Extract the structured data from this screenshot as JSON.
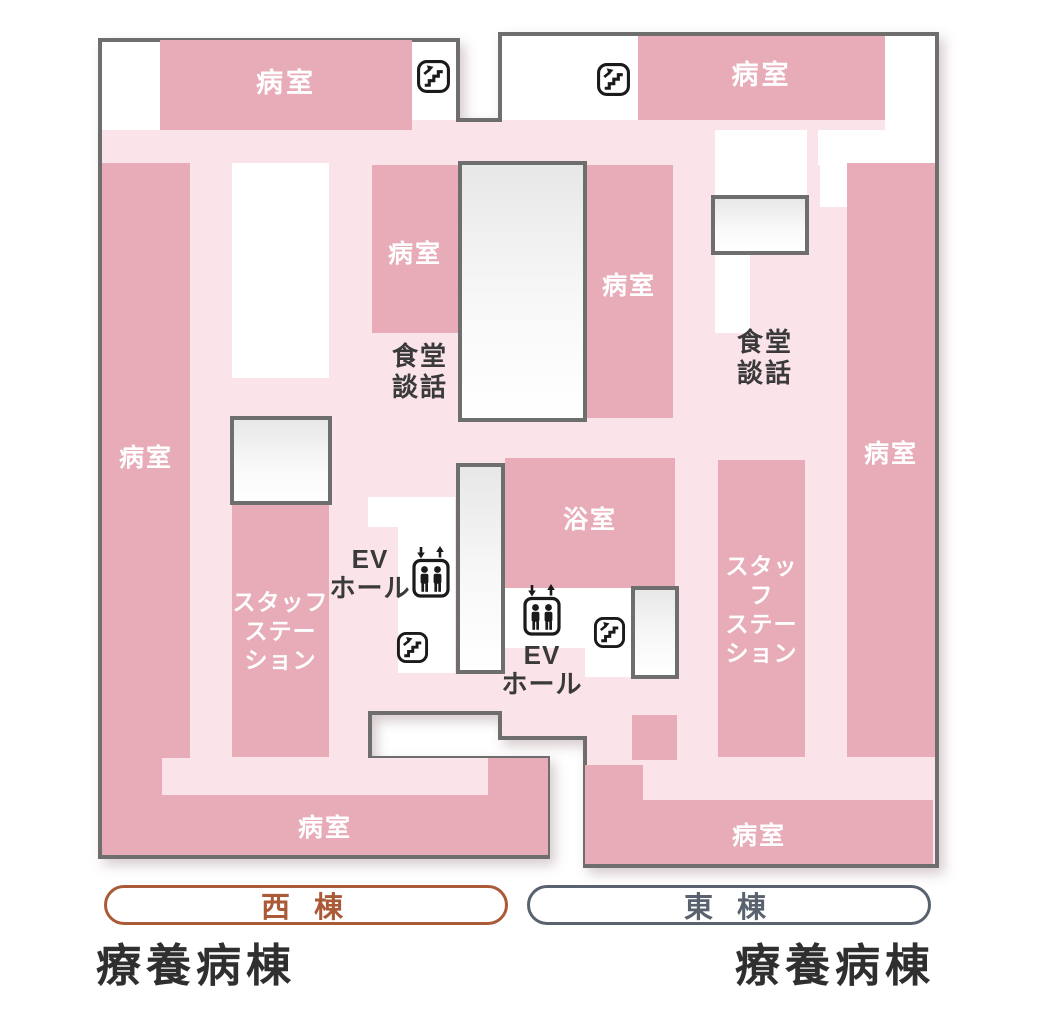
{
  "colors": {
    "room_pink": "#e7acb8",
    "corridor_pink": "#fbe4e9",
    "outline_gray": "#6e6e6e",
    "icon_black": "#1a1a1a",
    "west_wing_accent": "#ab5a38",
    "east_wing_accent": "#59626e",
    "ward_text": "#2f2f2f",
    "room_label_white": "#ffffff"
  },
  "rooms": {
    "west_top": "病室",
    "east_top": "病室",
    "west_left": "病室",
    "west_mid": "病室",
    "center_room": "病室",
    "east_right": "病室",
    "bath": "浴室",
    "west_bottom": "病室",
    "east_bottom": "病室",
    "staff_west": [
      "スタッフ",
      "ステー",
      "ション"
    ],
    "staff_east": [
      "スタッフ",
      "ステー",
      "ション"
    ]
  },
  "areas": {
    "dining_west": [
      "食堂",
      "談話"
    ],
    "dining_east": [
      "食堂",
      "談話"
    ],
    "ev_west": [
      "EV",
      "ホール"
    ],
    "ev_east": [
      "EV",
      "ホール"
    ]
  },
  "icons": {
    "stairs": "stairs-up",
    "elevator": "elevator"
  },
  "legend": {
    "west_wing": "西 棟",
    "east_wing": "東 棟",
    "west_ward": "療養病棟",
    "east_ward": "療養病棟"
  }
}
